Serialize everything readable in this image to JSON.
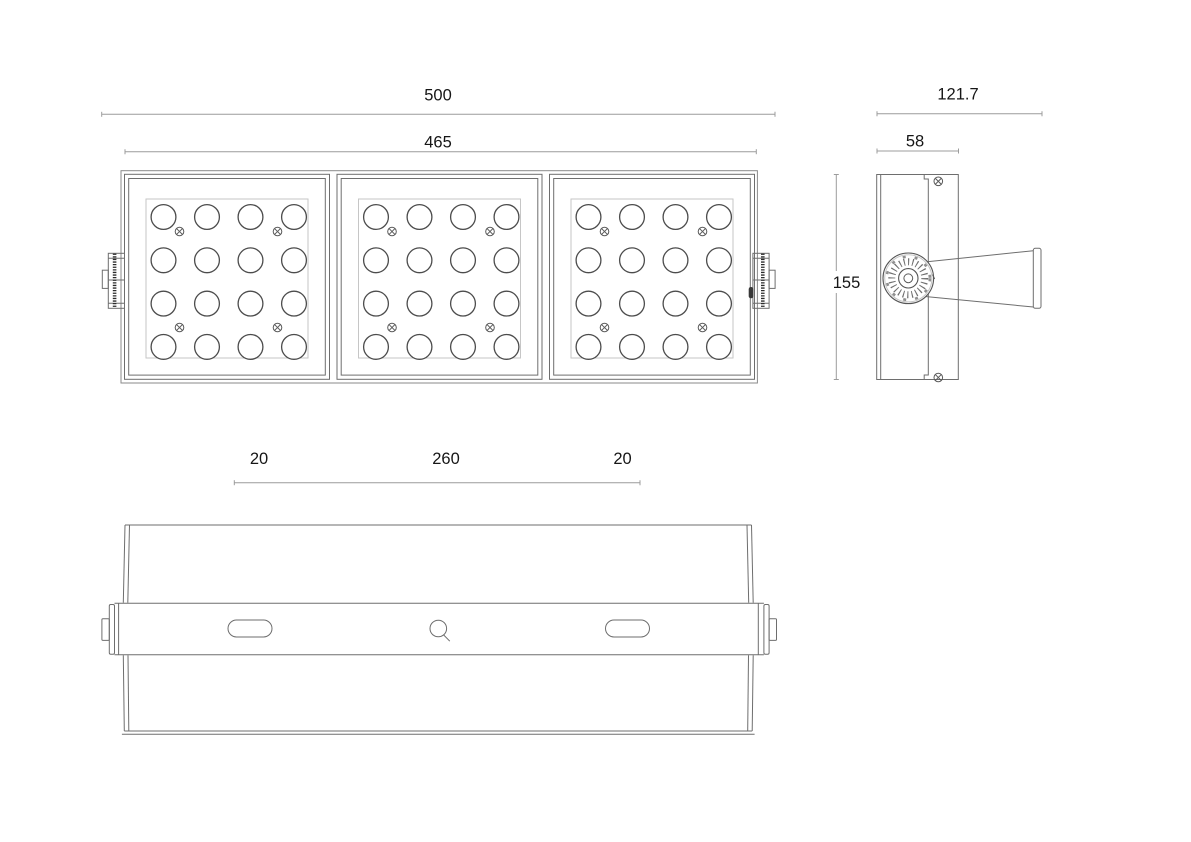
{
  "drawing": {
    "type": "technical-dimension-drawing",
    "subject": "modular LED floodlight, three views"
  },
  "front_view": {
    "dim_overall_width": "500",
    "dim_module_row_width": "465",
    "module_count": 3,
    "led_rows": 4,
    "led_cols": 4,
    "screws_per_module": 4
  },
  "side_view": {
    "dim_overall_depth": "121.7",
    "dim_body_depth": "58",
    "dim_height": "155"
  },
  "bottom_view": {
    "dim_left": "20",
    "dim_center": "260",
    "dim_right": "20",
    "slot_count": 2,
    "center_hole_count": 1
  },
  "colors": {
    "background": "#ffffff",
    "outline": "#6e6e6e",
    "detail": "#4c4c4c",
    "light_line": "#c6c6c6",
    "dimension_line": "#9c9c9c",
    "text": "#161616",
    "knurl": "#2b2b2b"
  }
}
